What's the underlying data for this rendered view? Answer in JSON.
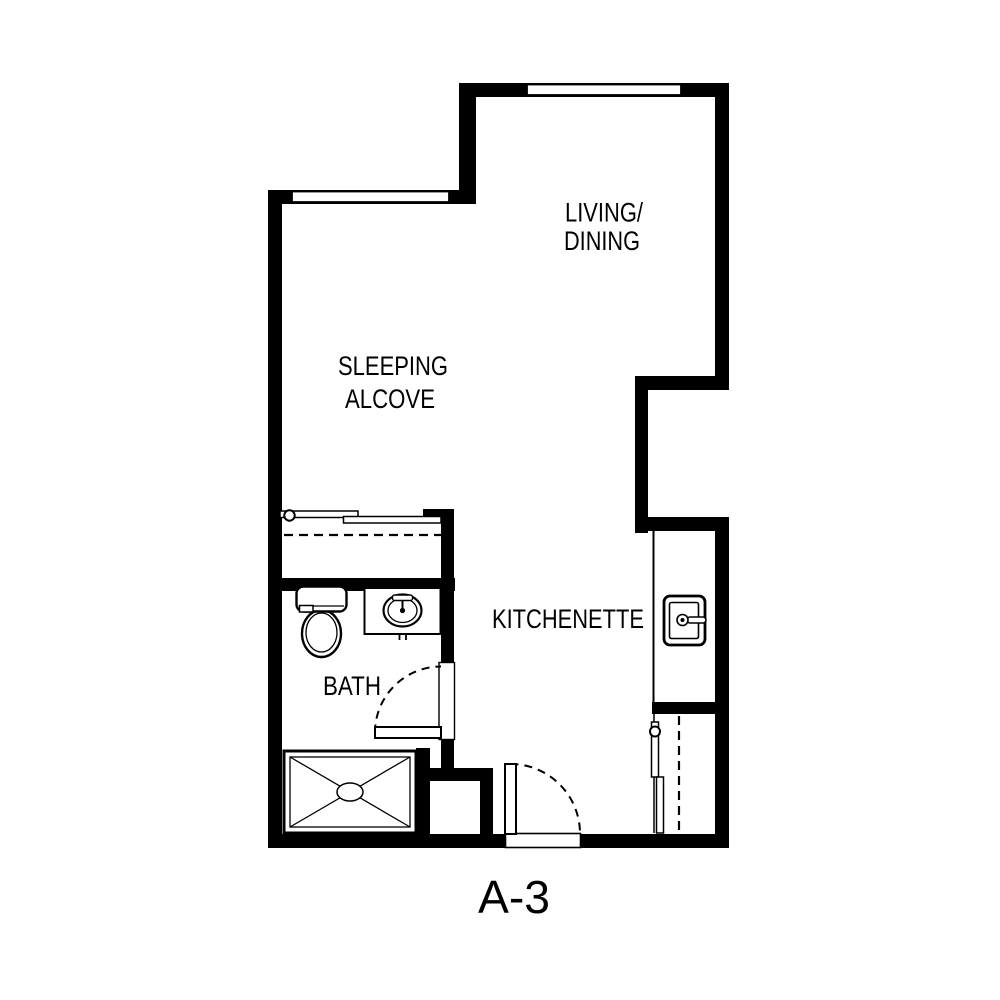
{
  "unit_label": "A-3",
  "rooms": {
    "living_dining": {
      "line1": "LIVING/",
      "line2": "DINING"
    },
    "sleeping_alcove": {
      "line1": "SLEEPING",
      "line2": "ALCOVE"
    },
    "kitchenette": {
      "label": "KITCHENETTE"
    },
    "bath": {
      "label": "BATH"
    }
  },
  "fixtures": {
    "shower": "shower-pan-with-cross",
    "toilet": "toilet-tank-and-bowl",
    "bath_sink": "oval-vanity-sink",
    "kitchen_sink": "kitchen-sink-with-faucet",
    "alcove_closet": "bypass-sliding-doors-with-dashed-rod",
    "entry_closet": "bypass-sliding-doors-with-dashed-rod",
    "bath_door": "hinged-door-dashed-swing",
    "entry_door": "hinged-door-dashed-swing",
    "window_count": 2
  },
  "colors": {
    "wall": "#000000",
    "floor": "#ffffff",
    "text": "#000000"
  }
}
